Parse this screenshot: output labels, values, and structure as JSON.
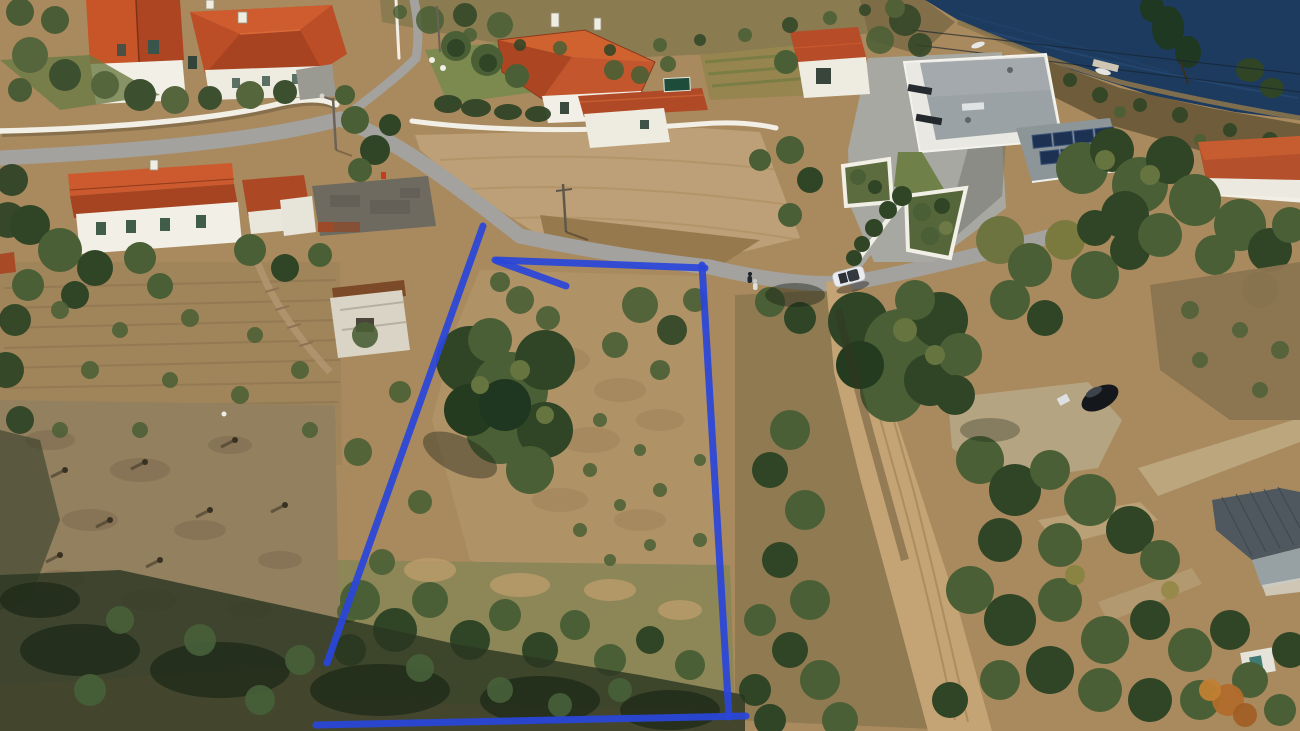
{
  "meta": {
    "type": "aerial-drone-photograph",
    "subject": "rural hillside village with a building plot outlined by a blue boundary overlay, river at top right",
    "width_px": 1300,
    "height_px": 731
  },
  "palette": {
    "water": "#1d3b5f",
    "asphalt": "#a3a29e",
    "dirt_road": "#c4a374",
    "dry_field": "#a98a5e",
    "burnt_field": "#93805f",
    "canopy_dark": "#2f4526",
    "canopy_mid": "#4a5f35",
    "canopy_light": "#66743f",
    "roof_red": "#bf4f28",
    "roof_gray": "#9aa2a5",
    "wall_white": "#f2efe7",
    "solar_panel": "#1d3152",
    "boundary_blue": "#2a46da",
    "shadow": "#2c3722"
  },
  "boundary": {
    "label": "plot-boundary-overlay",
    "color": "#2a46da",
    "stroke_width": 7,
    "segments": [
      {
        "name": "left-edge",
        "points": "483,226 327,663"
      },
      {
        "name": "top-edge",
        "points": "495,260 705,268"
      },
      {
        "name": "top-spur",
        "points": "497,261 566,286"
      },
      {
        "name": "right-edge",
        "points": "702,265 729,717"
      },
      {
        "name": "bottom-edge",
        "points": "316,725 746,716"
      }
    ]
  },
  "scene_objects": [
    "villa-with-red-tile-roofs-top-left",
    "white-boundary-wall",
    "asphalt-road",
    "uphill-lane",
    "red-roof-farmhouse-center-top",
    "garden-wall",
    "white-house-with-red-roof",
    "modern-flat-roof-house",
    "solar-panel-array",
    "river-water",
    "boat",
    "floating-dock",
    "headland",
    "old-houses-left",
    "rustic-sheds",
    "tarp-shack",
    "terraced-fields",
    "burnt-cleared-field",
    "marked-plot-scrubland",
    "dirt-track",
    "gravel-clearing",
    "parked-white-car",
    "parked-dark-car",
    "pedestrian-on-road",
    "gray-metal-roof-house",
    "white-teal-shed",
    "street-lamp",
    "power-lines"
  ]
}
